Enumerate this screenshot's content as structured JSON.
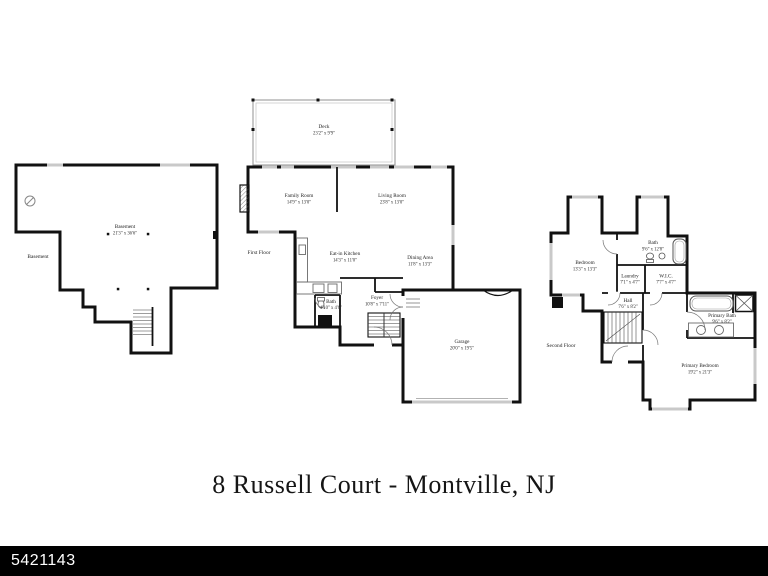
{
  "title": "8 Russell Court - Montville, NJ",
  "footer": {
    "listing_id": "5421143"
  },
  "colors": {
    "wall": "#111111",
    "window": "#c9c9c9",
    "fixture": "#6a6a6a",
    "banner": "#000000",
    "banner_text": "#ffffff",
    "background": "#ffffff"
  },
  "plans": {
    "basement": {
      "floor_label": "Basement",
      "rooms": {
        "basement": {
          "name": "Basement",
          "dims": "21'3\" x 36'6\""
        }
      }
    },
    "first_floor": {
      "floor_label": "First Floor",
      "rooms": {
        "deck": {
          "name": "Deck",
          "dims": "23'2\" x 9'9\""
        },
        "family_room": {
          "name": "Family Room",
          "dims": "14'9\" x 13'0\""
        },
        "living_room": {
          "name": "Living Room",
          "dims": "23'8\" x 13'0\""
        },
        "eat_in_kitchen": {
          "name": "Eat-in Kitchen",
          "dims": "14'3\" x 11'0\""
        },
        "dining_area": {
          "name": "Dining Area",
          "dims": "11'8\" x 13'3\""
        },
        "bath": {
          "name": "Bath",
          "dims": "4'10\" x 4'6\""
        },
        "foyer": {
          "name": "Foyer",
          "dims": "10'8\" x 7'11\""
        },
        "garage": {
          "name": "Garage",
          "dims": "20'0\" x 19'5\""
        }
      }
    },
    "second_floor": {
      "floor_label": "Second Floor",
      "rooms": {
        "bedroom": {
          "name": "Bedroom",
          "dims": "13'3\" x 13'3\""
        },
        "bath": {
          "name": "Bath",
          "dims": "9'6\" x 12'8\""
        },
        "laundry": {
          "name": "Laundry",
          "dims": "7'1\" x 4'7\""
        },
        "wic": {
          "name": "W.I.C.",
          "dims": "7'7\" x 4'7\""
        },
        "hall": {
          "name": "Hall",
          "dims": "7'6\" x 8'2\""
        },
        "primary_bath": {
          "name": "Primary Bath",
          "dims": "9'6\" x 8'2\""
        },
        "primary_bedroom": {
          "name": "Primary Bedroom",
          "dims": "19'2\" x 21'3\""
        }
      }
    }
  }
}
